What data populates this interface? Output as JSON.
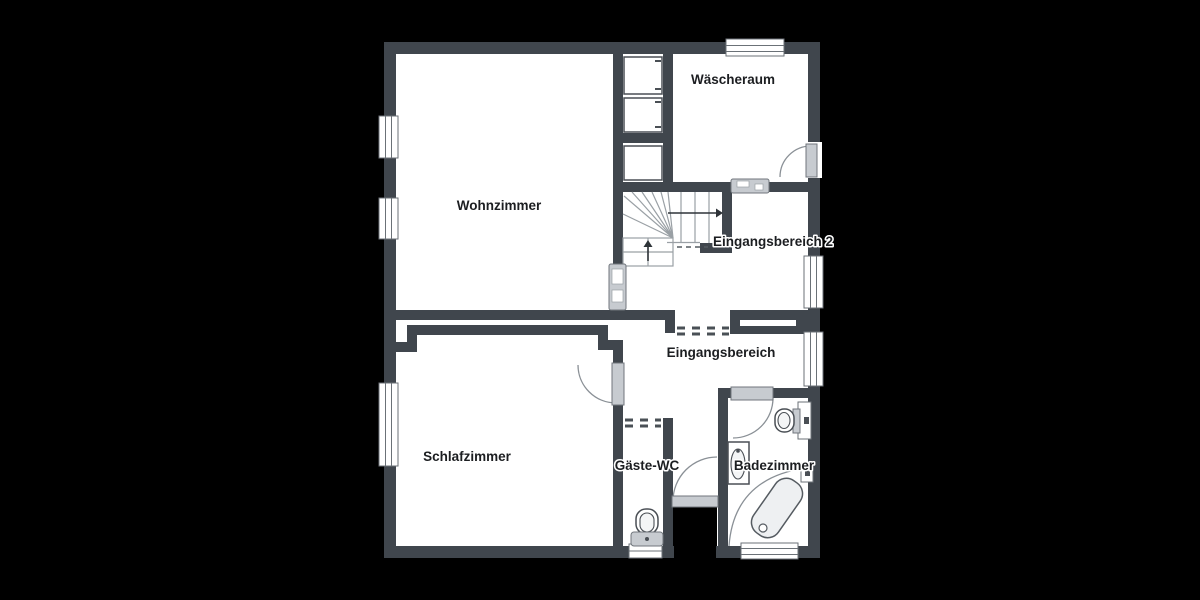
{
  "canvas": {
    "width": 1200,
    "height": 600,
    "background": "#000000"
  },
  "palette": {
    "floor": "#ffffff",
    "wall": "#40464d",
    "fixture": "#c7cbd0",
    "fixture_fill": "#eef0f2",
    "outline": "#4a4f55",
    "label_text": "#1c1e21"
  },
  "rooms": [
    {
      "id": "wohnzimmer",
      "label": "Wohnzimmer"
    },
    {
      "id": "waescheraum",
      "label": "Wäscheraum"
    },
    {
      "id": "eingangsbereich-2",
      "label": "Eingangsbereich 2"
    },
    {
      "id": "eingangsbereich",
      "label": "Eingangsbereich"
    },
    {
      "id": "schlafzimmer",
      "label": "Schlafzimmer"
    },
    {
      "id": "gaeste-wc",
      "label": "Gäste-WC"
    },
    {
      "id": "badezimmer",
      "label": "Badezimmer"
    }
  ],
  "fixtures": [
    "washing-machine",
    "washing-machine",
    "cabinet",
    "pocket-door",
    "pocket-door",
    "staircase",
    "toilet",
    "toilet",
    "sink",
    "bathtub",
    "wall-niche"
  ],
  "doors": [
    "waescheraum-exterior-door",
    "schlafzimmer-door",
    "badezimmer-door",
    "entrance-door"
  ]
}
